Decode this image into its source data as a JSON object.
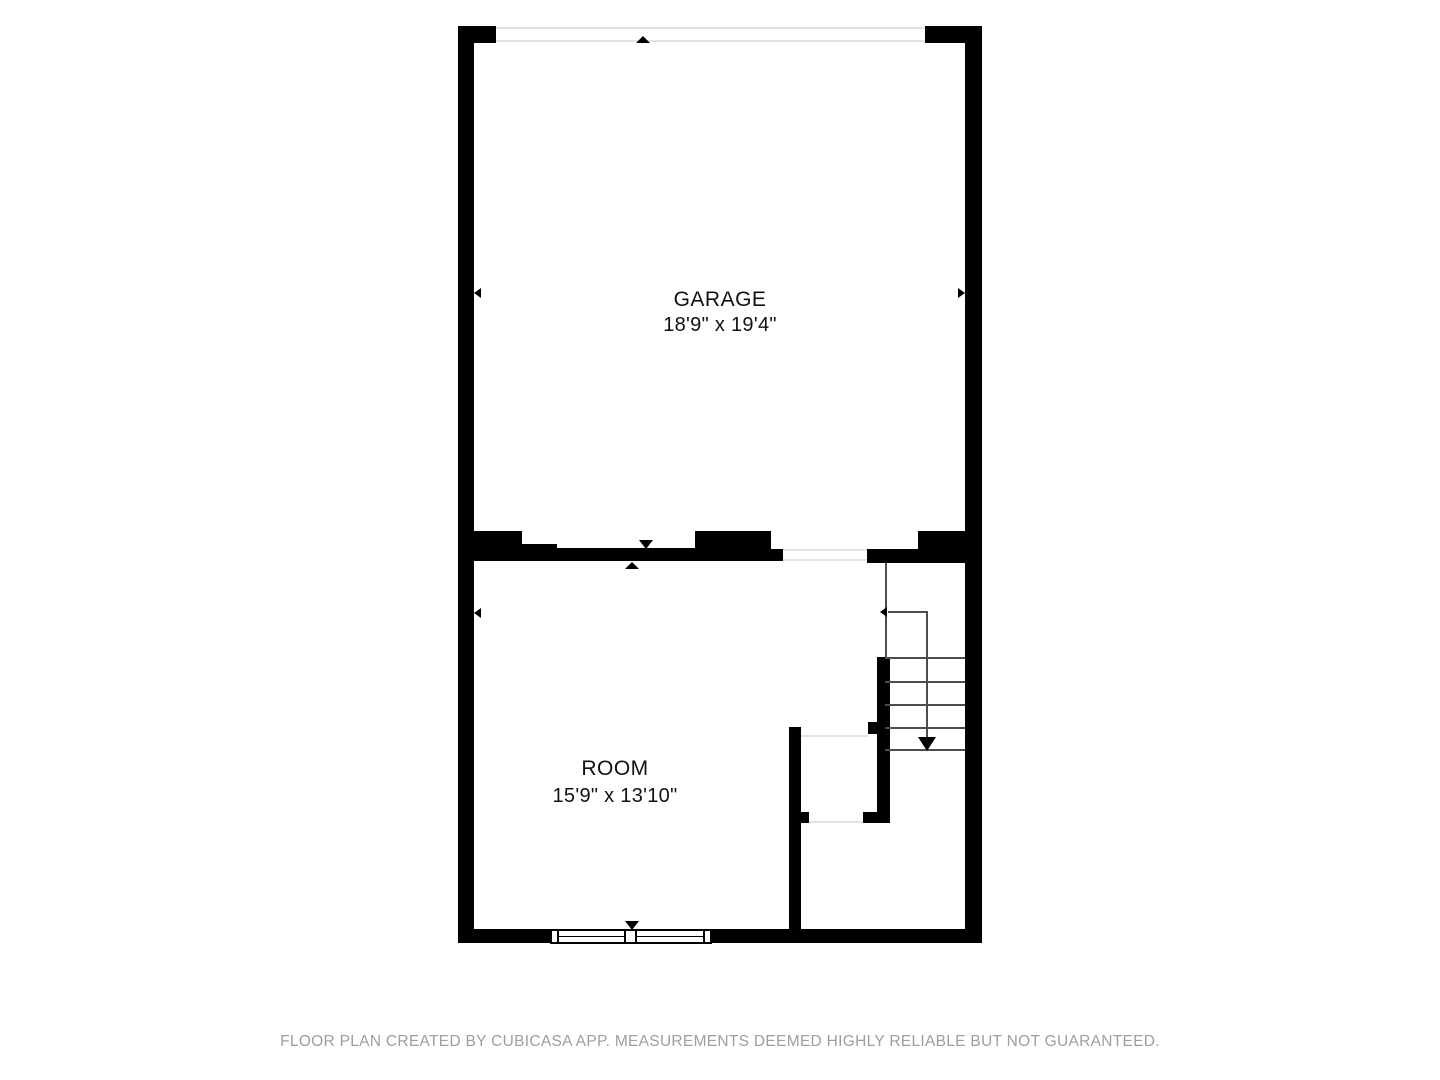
{
  "document": {
    "type": "floor-plan",
    "creator_note": "FLOOR PLAN CREATED BY CUBICASA APP. MEASUREMENTS DEEMED HIGHLY RELIABLE BUT NOT GUARANTEED."
  },
  "rooms": {
    "garage": {
      "name": "GARAGE",
      "dimensions": "18'9\" x 19'4\""
    },
    "room": {
      "name": "ROOM",
      "dimensions": "15'9\" x 13'10\""
    }
  },
  "stairs": {
    "direction": "down",
    "tread_count": 5
  },
  "colors": {
    "wall": "#000000",
    "opening_line": "#e2e2e2",
    "stair_line": "#4d4d4d",
    "label_text": "#111111",
    "footer_text": "#9e9e9e",
    "background": "#ffffff"
  }
}
